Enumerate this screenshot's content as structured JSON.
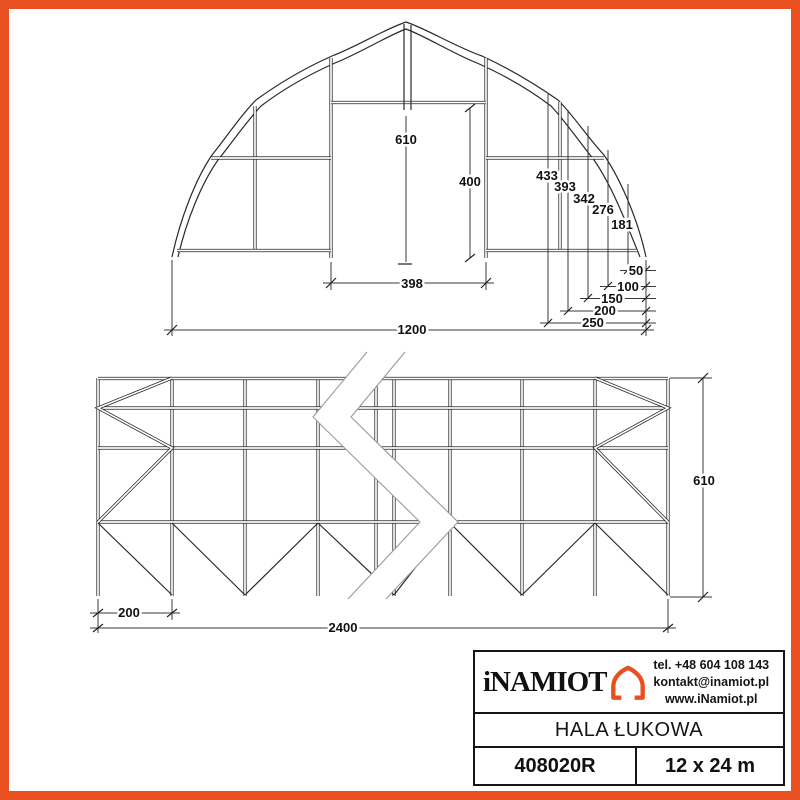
{
  "colors": {
    "accent": "#E8501F",
    "line": "#222222"
  },
  "front_view": {
    "dims": {
      "ridge_height": "610",
      "door_height": "400",
      "door_width": "398",
      "total_width": "1200",
      "h_at_250": "433",
      "h_at_200": "393",
      "h_at_150": "342",
      "h_at_100": "276",
      "h_at_50": "181",
      "offset_50": "50",
      "offset_100": "100",
      "offset_150": "150",
      "offset_200": "200",
      "offset_250": "250"
    }
  },
  "side_view": {
    "dims": {
      "bay_spacing": "200",
      "total_length": "2400",
      "height": "610"
    }
  },
  "title_block": {
    "brand": "iNAMIOT",
    "contact": {
      "phone": "tel. +48 604 108 143",
      "email": "kontakt@inamiot.pl",
      "website": "www.iNamiot.pl"
    },
    "product_name": "HALA ŁUKOWA",
    "model": "408020R",
    "dimensions": "12 x 24 m"
  }
}
